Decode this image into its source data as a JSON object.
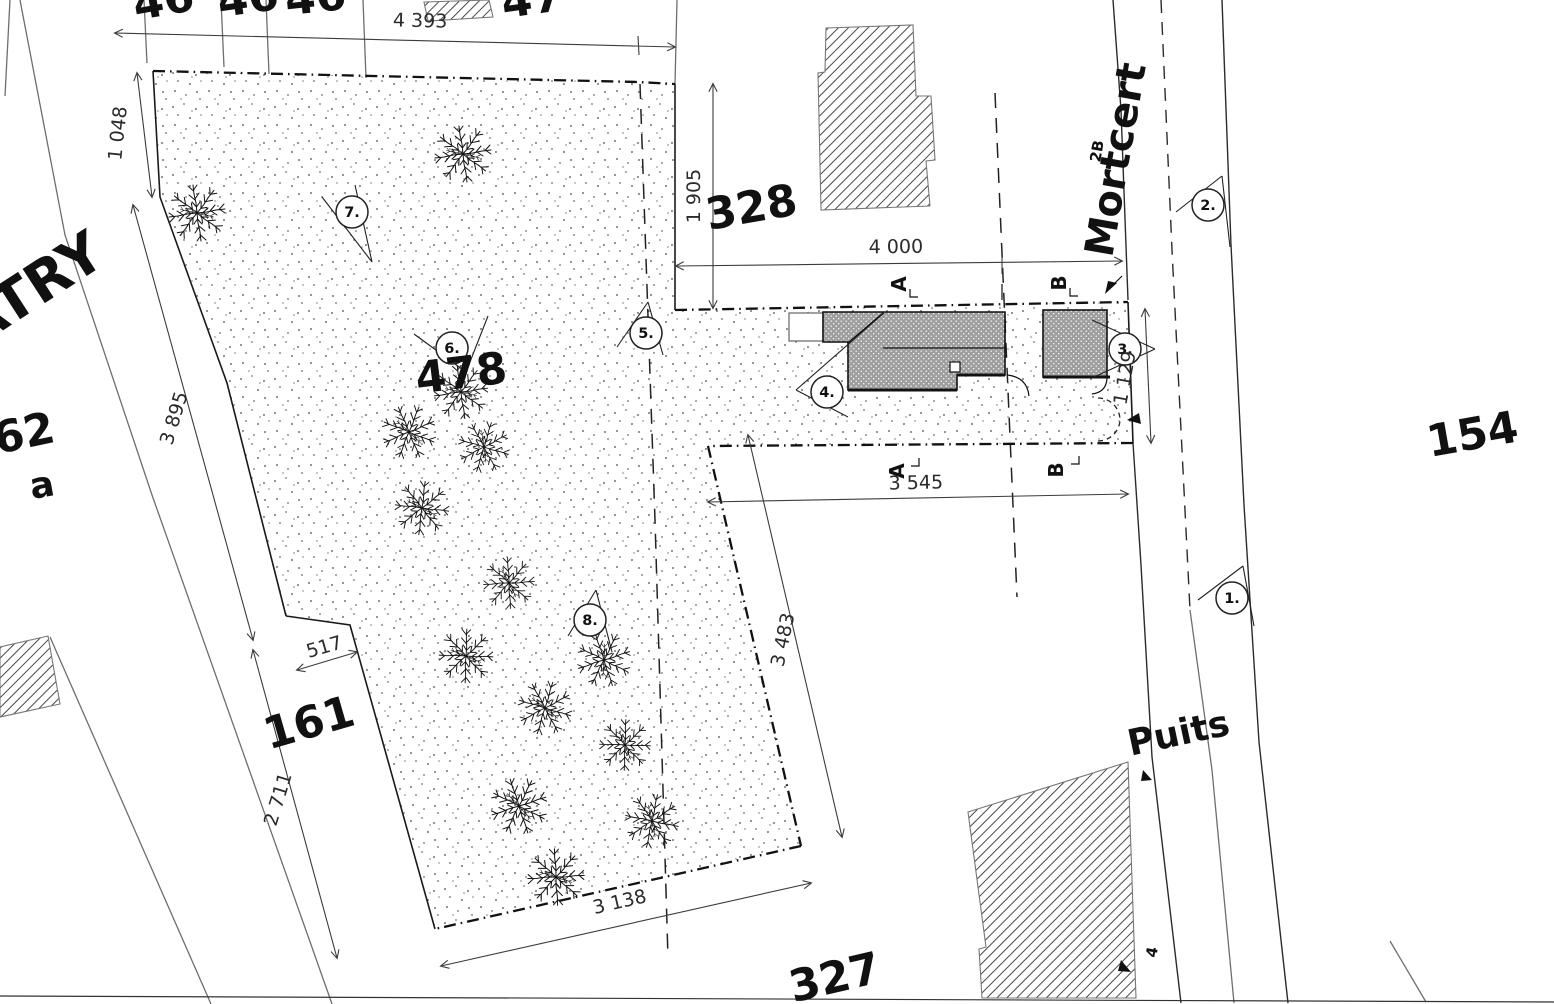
{
  "labels": {
    "parcels": {
      "p478": "478",
      "p328": "328",
      "p161": "161",
      "p162": "162",
      "p162_sub": "a",
      "p154": "154",
      "p327": "327",
      "p2b": "2B",
      "p4": "4",
      "p46a": "46",
      "p46b": "46",
      "p46c": "46",
      "p47": "47"
    },
    "streets": {
      "mortcert": "Mortcert",
      "puits": "Puits",
      "atry": "ATRY"
    },
    "sections": {
      "a_top": "A",
      "b_top": "B",
      "a_bottom": "A",
      "b_bottom": "B"
    },
    "viewpoints": {
      "v1": "1.",
      "v2": "2.",
      "v3": "3.",
      "v4": "4.",
      "v5": "5.",
      "v6": "6.",
      "v7": "7.",
      "v8": "8."
    },
    "dimensions": {
      "d4393": "4 393",
      "d1048": "1 048",
      "d3895": "3 895",
      "d2711": "2 711",
      "d517": "517",
      "d3138": "3 138",
      "d3483": "3 483",
      "d3545": "3 545",
      "d1905": "1 905",
      "d4000": "4 000",
      "d1129": "1 129"
    }
  },
  "colors": {
    "ink": "#1a1a1a",
    "dimension": "#3c3c3c",
    "road": "#6e6e6e",
    "building_fill": "#9e9e9e",
    "stipple_dot": "#8a8a8a",
    "background": "#ffffff"
  }
}
